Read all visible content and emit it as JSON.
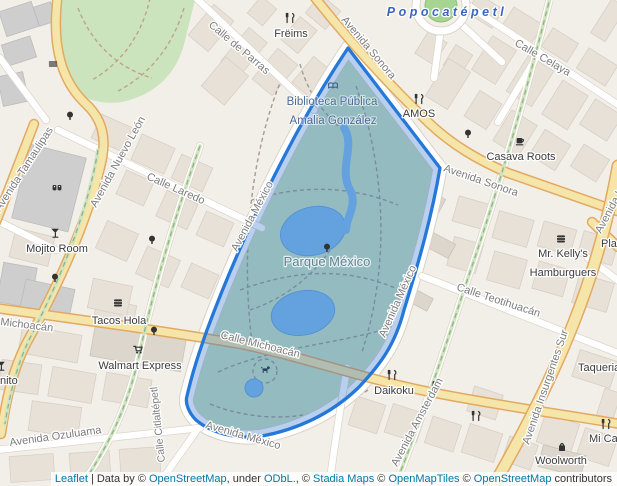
{
  "map": {
    "area_labels": {
      "popocatepetl": "Popocatépetl",
      "parque_mexico": "Parque México",
      "biblioteca_line1": "Biblioteca Pública",
      "biblioteca_line2": "Amalia González"
    },
    "street_labels": {
      "sonora_nw": "Avenida Sonora",
      "sonora_e": "Avenida Sonora",
      "parras": "Calle de Parras",
      "celaya": "Calle Celaya",
      "nuevo_leon": "Avenida Nuevo León",
      "tamaulipas": "Avenida Tamaulipas",
      "laredo": "Calle Laredo",
      "mexico_w": "Avenida México",
      "mexico_e": "Avenida México",
      "mexico_s": "Avenida México",
      "michoacan_w": "Michoacán",
      "michoacan_park": "Calle Michoacán",
      "teotihuacan": "Calle Teotihuacán",
      "amsterdam": "Avenida Amsterdam",
      "insurgentes": "Avenida Insurgentes Sur",
      "insurgentes_n": "Avenida In",
      "ozuluama": "Avenida Ozuluama",
      "citlaltepetl": "Calle Citlaltépetl"
    },
    "poi_labels": {
      "freims": "Frëims",
      "amos": "AMOS",
      "casava": "Casava Roots",
      "mojito": "Mojito Room",
      "tacos": "Tacos Hola",
      "walmart": "Walmart Express",
      "daikoku": "Daikoku",
      "kellys_line1": "Mr. Kelly's",
      "kellys_line2": "Hamburguers",
      "woolworth": "Woolworth",
      "taqueria": "Taqueria",
      "mica": "Mi Ca",
      "pla": "Pla",
      "nito": "nito"
    },
    "icons": {
      "freims": "restaurant-icon",
      "amos": "restaurant-icon",
      "daikoku": "restaurant-icon",
      "casava": "cafe-icon",
      "amsterdam_cafe": "cafe-icon",
      "mojito": "cocktail-icon",
      "nito": "cocktail-icon",
      "tacos": "fast-food-icon",
      "kellys": "fast-food-icon",
      "walmart": "supermarket-cart-icon",
      "woolworth": "shopping-bag-icon",
      "biblioteca": "library-book-icon",
      "parque": "tree-icon",
      "theatre": "theatre-masks-icon",
      "bench": "bench-icon",
      "dog_park": "dog-icon"
    }
  },
  "colors": {
    "polygon_stroke": "#2578d8",
    "polygon_fill_rgba": "rgba(35,105,200,0.32)",
    "water": "#84bdeb",
    "major_road": "#f6e5a8",
    "green_area": "#cbe4bd",
    "land": "#f2efe9",
    "link": "#0078a8",
    "plaza_label": "#3a66c0"
  },
  "attribution": {
    "leaflet": "Leaflet",
    "pipe": "|",
    "data_by": "Data by ©",
    "osm": "OpenStreetMap",
    "comma_under": ", under",
    "odbl": "ODbL.",
    "c1": ", ©",
    "stadia": "Stadia Maps",
    "c2": "©",
    "openmaptiles": "OpenMapTiles",
    "c3": "©",
    "osm2": "OpenStreetMap",
    "contributors": "contributors"
  }
}
